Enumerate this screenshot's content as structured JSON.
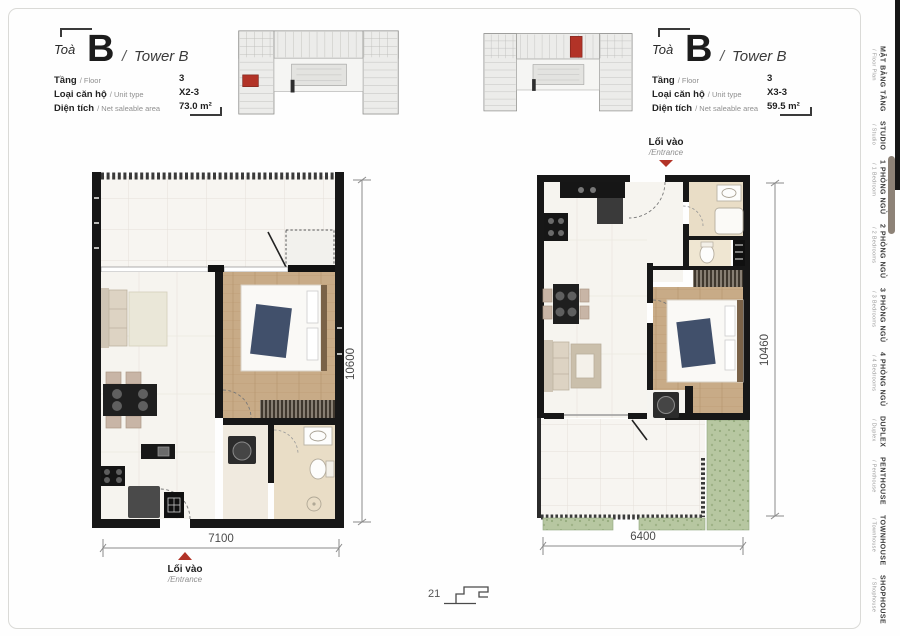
{
  "page": {
    "number": "21"
  },
  "colors": {
    "accent_red": "#b23327",
    "wall_black": "#171717",
    "greenery": "#b7c7a1",
    "wood_floor": "#c8ab87",
    "bath_beige": "#e9ddc6"
  },
  "units": {
    "left": {
      "building_label": "Toà",
      "building_letter": "B",
      "separator": "/",
      "building_name": "Tower B",
      "rows": [
        {
          "label": "Tầng",
          "sublabel": "/ Floor",
          "value": "3"
        },
        {
          "label": "Loại căn hộ",
          "sublabel": "/ Unit type",
          "value": "X2-3"
        },
        {
          "label": "Diện tích",
          "sublabel": "/ Net saleable area",
          "value": "73.0 m²"
        }
      ],
      "dim_width": "7100",
      "dim_height": "10600",
      "entrance_vi": "Lối vào",
      "entrance_en": "/Entrance"
    },
    "right": {
      "building_label": "Toà",
      "building_letter": "B",
      "separator": "/",
      "building_name": "Tower B",
      "rows": [
        {
          "label": "Tầng",
          "sublabel": "/ Floor",
          "value": "3"
        },
        {
          "label": "Loại căn hộ",
          "sublabel": "/ Unit type",
          "value": "X3-3"
        },
        {
          "label": "Diện tích",
          "sublabel": "/ Net saleable area",
          "value": "59.5 m²"
        }
      ],
      "dim_width": "6400",
      "dim_height": "10460",
      "entrance_vi": "Lối vào",
      "entrance_en": "/Entrance"
    }
  },
  "sidebar": {
    "items": [
      {
        "vi": "MẶT BẰNG TẦNG",
        "en": "/ Floor Plan"
      },
      {
        "vi": "STUDIO",
        "en": "/ Studio"
      },
      {
        "vi": "1 PHÒNG NGỦ",
        "en": "/ 1 Bedroom"
      },
      {
        "vi": "2 PHÒNG NGỦ",
        "en": "/ 2 Bedrooms"
      },
      {
        "vi": "3 PHÒNG NGỦ",
        "en": "/ 3 Bedrooms"
      },
      {
        "vi": "4 PHÒNG NGỦ",
        "en": "/ 4 Bedrooms"
      },
      {
        "vi": "DUPLEX",
        "en": "/ Duplex"
      },
      {
        "vi": "PENTHOUSE",
        "en": "/ Penthouse"
      },
      {
        "vi": "TOWNHOUSE",
        "en": "/ Townhouse"
      },
      {
        "vi": "SHOPHOUSE",
        "en": "/ Shophouse"
      }
    ]
  }
}
